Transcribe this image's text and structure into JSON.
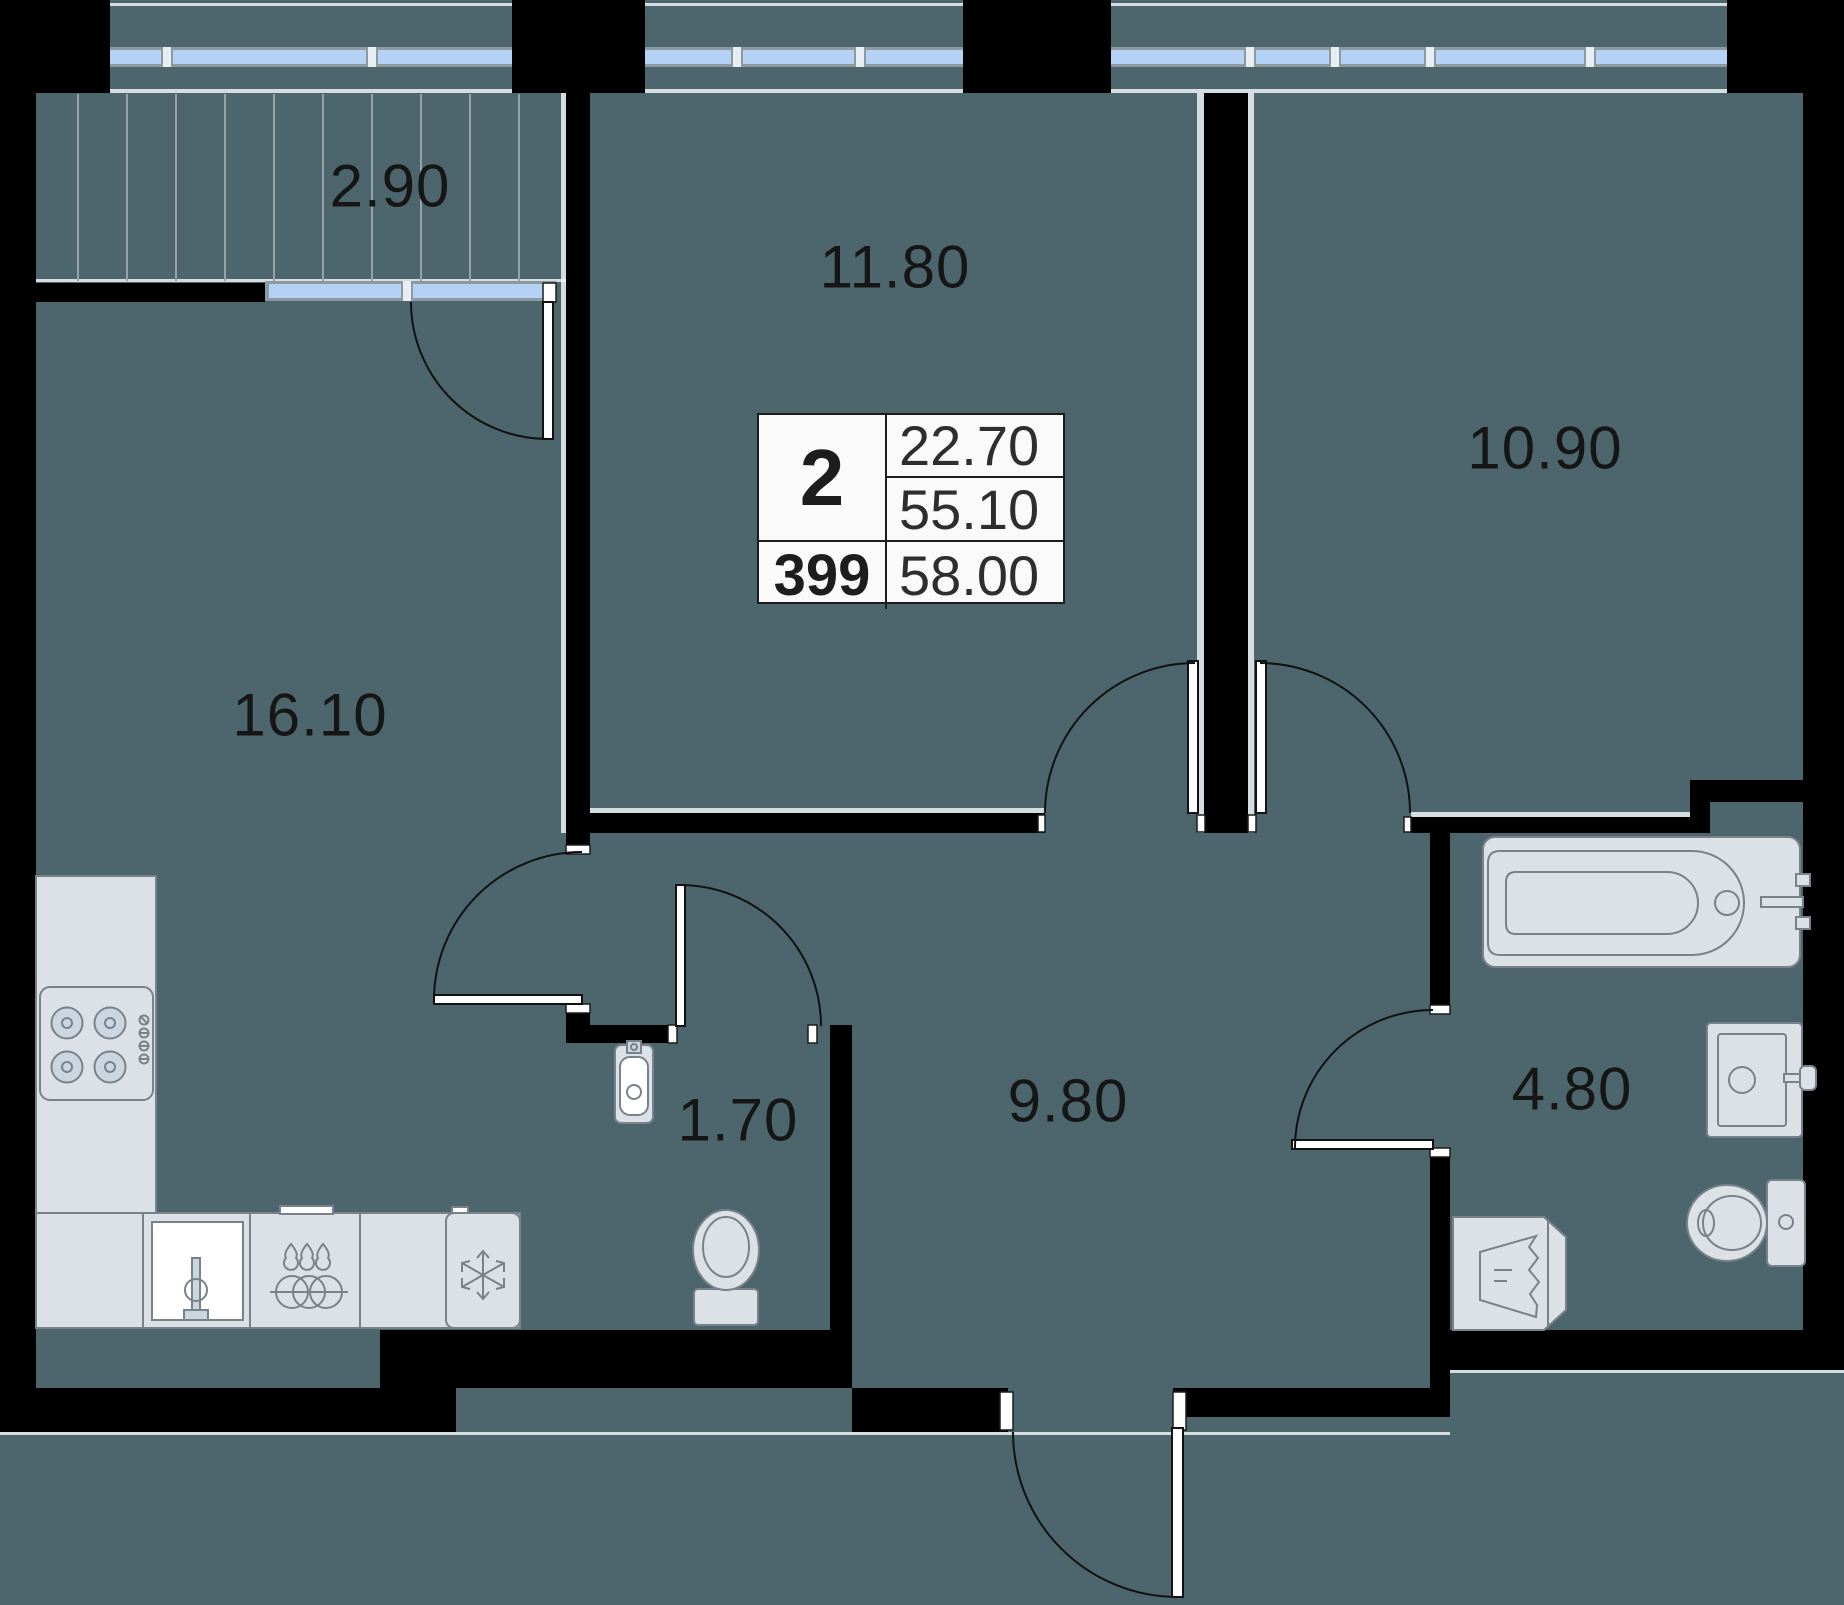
{
  "floor_plan": {
    "info_box": {
      "room_count": "2",
      "apartment_number": "399",
      "living_area": "22.70",
      "floor_area": "55.10",
      "total_area": "58.00"
    },
    "room_labels": [
      {
        "name": "balcony",
        "area": "2.90"
      },
      {
        "name": "room-top",
        "area": "11.80"
      },
      {
        "name": "room-right",
        "area": "10.90"
      },
      {
        "name": "kitchen-living-room",
        "area": "16.10"
      },
      {
        "name": "wc",
        "area": "1.70"
      },
      {
        "name": "hallway",
        "area": "9.80"
      },
      {
        "name": "bathroom",
        "area": "4.80"
      }
    ],
    "colors": {
      "background": "#4d666e",
      "wall": "#000000",
      "window": "#b5d1f3",
      "window_frame": "#8d99a1",
      "fixture_fill": "#dce1e7",
      "fixture_stroke": "#79828a",
      "label": "#161616",
      "table_bg": "#fafafa",
      "table_border": "#1c1c1c"
    }
  }
}
